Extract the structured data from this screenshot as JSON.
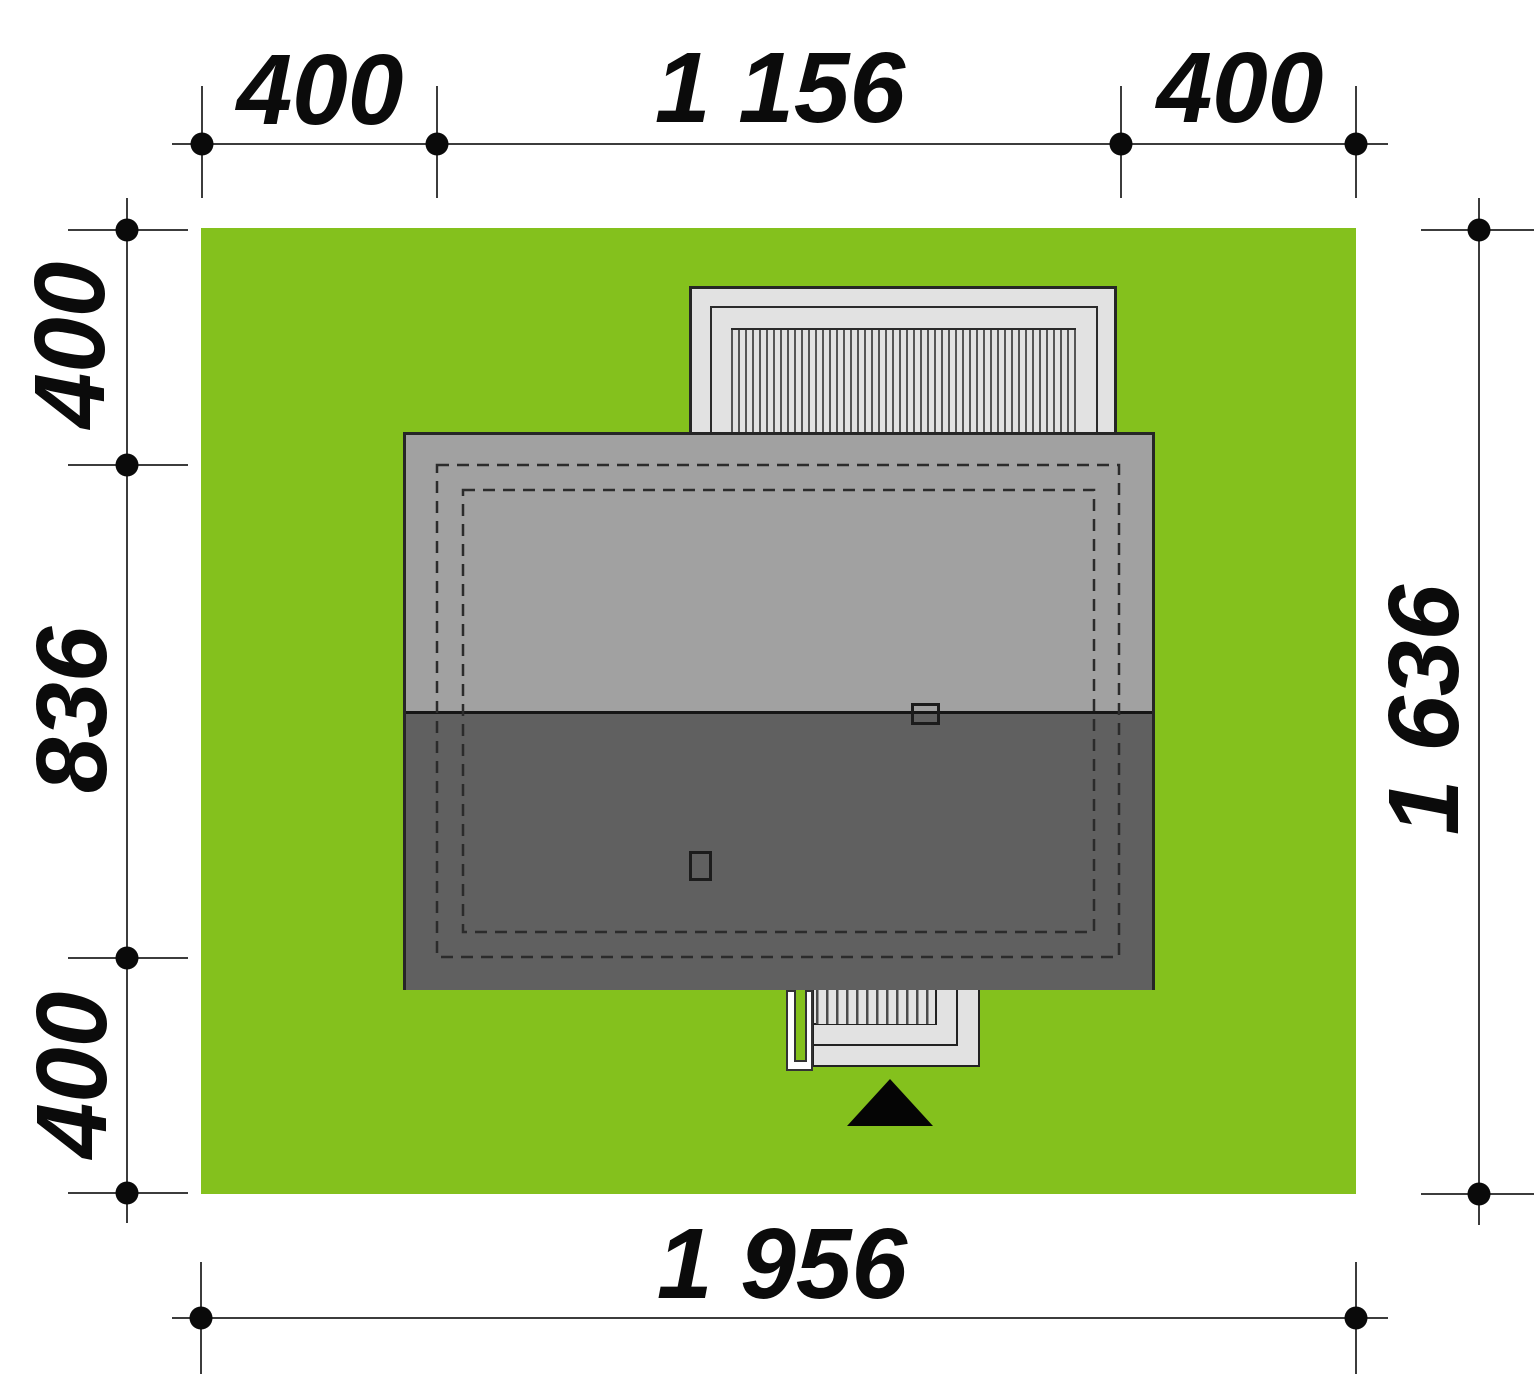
{
  "plan": {
    "kind": "house site plan (roof view)",
    "dimensions": {
      "top": {
        "left_margin": "400",
        "building_width": "1 156",
        "right_margin": "400"
      },
      "left": {
        "top_margin": "400",
        "building_depth": "836",
        "bottom_margin": "400"
      },
      "right": {
        "plot_depth": "1 636"
      },
      "bottom": {
        "plot_width": "1 956"
      }
    },
    "colors": {
      "grass": "#84c11d",
      "roof_upper_slope": "#a1a1a1",
      "roof_lower_slope": "#606060",
      "paving": "#e2e2e2",
      "outline": "#262626",
      "dimension_ink": "#0b0b0b"
    }
  }
}
